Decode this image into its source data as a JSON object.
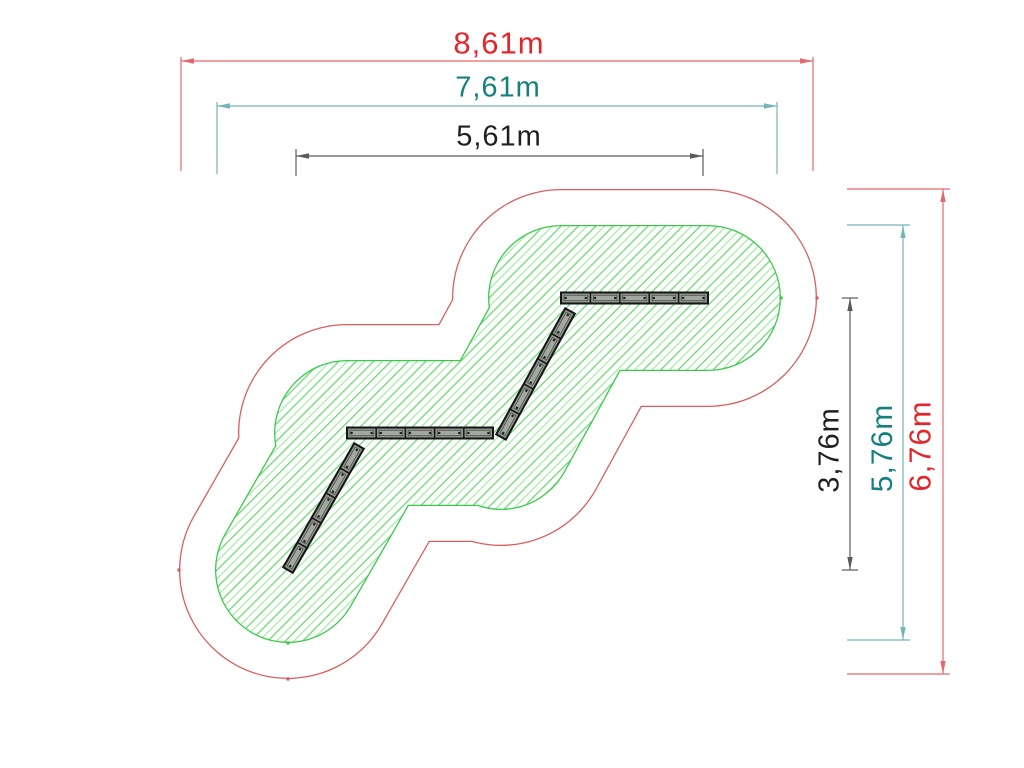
{
  "diagram": {
    "type": "playground-equipment-safety-zone-plan",
    "units": "m",
    "scale_px_per_m": 72.6,
    "colors": {
      "outer_zone_line": "#d95f5f",
      "inner_zone_line": "#3cc94a",
      "hatch_line_a": "#58d862",
      "hatch_line_b": "#9debA2",
      "beam_fill": "#8b9089",
      "beam_band": "#a2a89f",
      "beam_outline": "#161616",
      "beam_screw": "#1d201c",
      "dim_red_line": "#e4686a",
      "dim_red_text": "#e2262c",
      "dim_teal_line": "#76b5b5",
      "dim_teal_text": "#17807f",
      "dim_black_line": "#5a5a5a",
      "dim_black_text": "#1f1f1f",
      "white": "#ffffff"
    },
    "equipment": {
      "description": "zigzag of four balance beams",
      "beam_thickness": 11,
      "planks_per_beam": 5,
      "beams": [
        [
          561,
          298,
          708,
          298
        ],
        [
          570,
          311,
          501,
          437
        ],
        [
          347,
          433,
          493,
          433
        ],
        [
          359,
          446,
          288,
          570
        ]
      ]
    },
    "zones": {
      "outer_radius_px": 109,
      "inner_radius_px": 73,
      "outline_width": 1.3,
      "hatch_spacing_px": 12.3,
      "hatch_angle_deg": 45
    },
    "markers": [
      {
        "x": 817,
        "y": 298,
        "c": "red"
      },
      {
        "x": 781,
        "y": 298,
        "c": "green"
      },
      {
        "x": 288,
        "y": 679,
        "c": "red"
      },
      {
        "x": 288,
        "y": 643,
        "c": "green"
      },
      {
        "x": 179,
        "y": 570,
        "c": "red"
      }
    ],
    "dims_h": [
      {
        "label": "8,61m",
        "value_m": 8.61,
        "color": "red",
        "y": 61,
        "x1": 181,
        "x2": 813,
        "ext_y1": 57,
        "ext_y2": 171,
        "label_x": 499,
        "label_y": 43,
        "font": 31
      },
      {
        "label": "7,61m",
        "value_m": 7.61,
        "color": "teal",
        "y": 106,
        "x1": 217,
        "x2": 777,
        "ext_y1": 102,
        "ext_y2": 174,
        "label_x": 498,
        "label_y": 88,
        "font": 29
      },
      {
        "label": "5,61m",
        "value_m": 5.61,
        "color": "black",
        "y": 156,
        "x1": 296,
        "x2": 703,
        "ext_y1": 149,
        "ext_y2": 176,
        "label_x": 499,
        "label_y": 137,
        "font": 29
      }
    ],
    "dims_v": [
      {
        "label": "3,76m",
        "value_m": 3.76,
        "color": "black",
        "x": 850,
        "y1": 298,
        "y2": 570,
        "ext_x1": 842,
        "ext_x2": 858,
        "label_x": 830,
        "label_y": 450,
        "font": 29
      },
      {
        "label": "5,76m",
        "value_m": 5.76,
        "color": "teal",
        "x": 903,
        "y1": 225,
        "y2": 640,
        "ext_x1": 847,
        "ext_x2": 910,
        "label_x": 883,
        "label_y": 448,
        "font": 30
      },
      {
        "label": "6,76m",
        "value_m": 6.76,
        "color": "red",
        "x": 943,
        "y1": 189,
        "y2": 674,
        "ext_x1": 847,
        "ext_x2": 950,
        "label_x": 920,
        "label_y": 446,
        "font": 31
      }
    ]
  }
}
